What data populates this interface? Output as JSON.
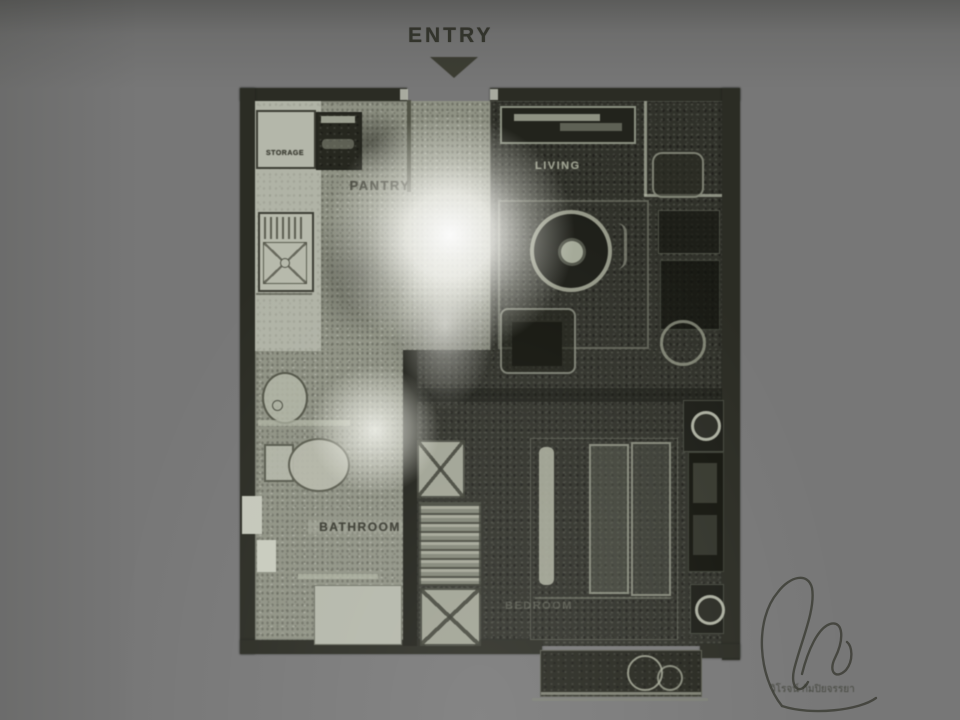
{
  "labels": {
    "entry": "ENTRY",
    "storage": "STORAGE",
    "pantry": "PANTRY",
    "living": "LIVING",
    "bathroom": "BATHROOM",
    "bedroom": "BEDROOM"
  },
  "signature": {
    "name_text": "วิโรจน์ กัมปิยจรรยา"
  },
  "colors": {
    "paper": "#a9ac9f",
    "ink_dark": "#2b2c24",
    "plan_mid": "#8f9284",
    "plan_light": "#b0b3a6",
    "label_light": "#a8ac9a",
    "label_dark": "#3b3c32"
  }
}
